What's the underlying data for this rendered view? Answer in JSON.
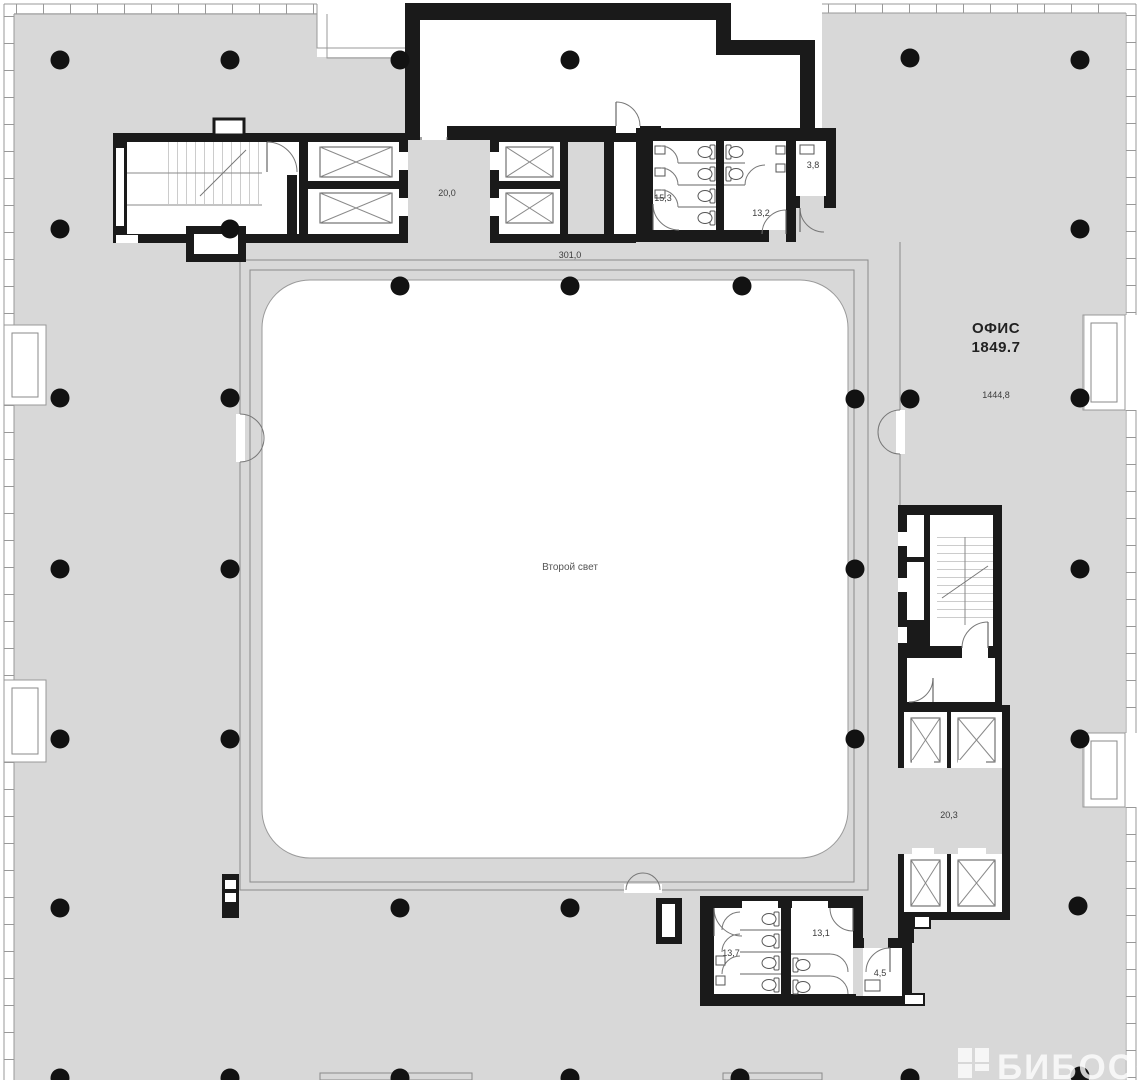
{
  "labels": {
    "office_name": "ОФИС",
    "office_area": "1849.7",
    "office_sub_area": "1444,8",
    "atrium": "Второй свет",
    "corridor_area": "301,0",
    "lobby_top": "20,0",
    "wc_top_left": "15,3",
    "wc_top_right": "13,2",
    "wc_top_small": "3,8",
    "lobby_right": "20,3",
    "wc_bottom_left": "13,7",
    "wc_bottom_right": "13,1",
    "wc_bottom_small": "4,5"
  },
  "watermark": {
    "text": "БИБОСС"
  },
  "colors": {
    "floor": "#d8d8d8",
    "wall": "#1a1a1a",
    "facade_line": "#999999",
    "column": "#121212",
    "watermark": "#ffffff"
  }
}
